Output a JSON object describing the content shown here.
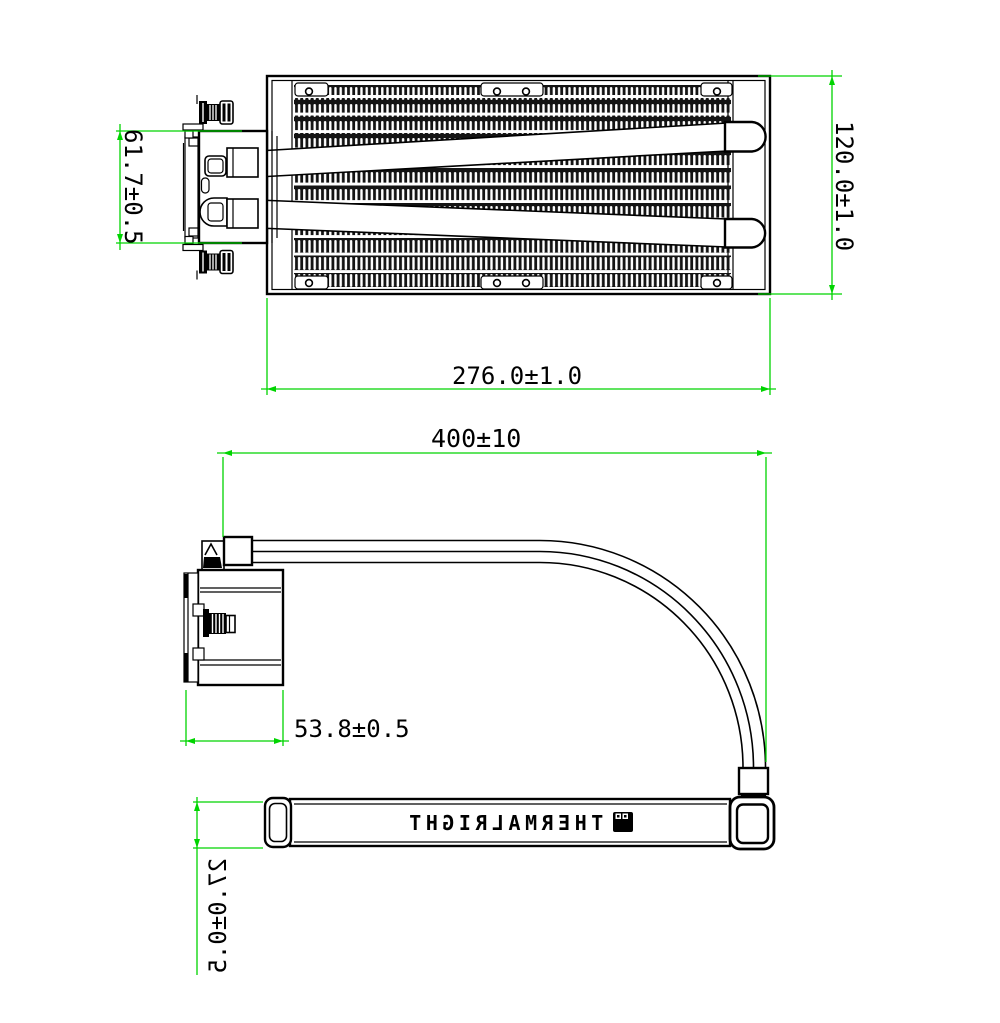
{
  "drawing": {
    "brand_label": "THERMALRIGHT",
    "colors": {
      "line": "#000000",
      "dimension": "#00d400",
      "fin_dark": "#141414",
      "background": "#ffffff"
    },
    "dimensions": {
      "pump_width_top": "61.7±0.5",
      "radiator_width": "120.0±1.0",
      "radiator_length": "276.0±1.0",
      "tube_length": "400±10",
      "pump_depth_side": "53.8±0.5",
      "radiator_thickness": "27.0±0.5"
    }
  }
}
